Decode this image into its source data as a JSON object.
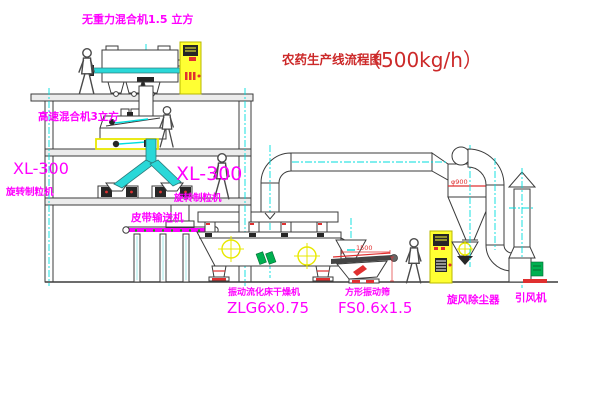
{
  "title": {
    "name": "农药生产线流程图",
    "capacity": "（500kg/h）"
  },
  "equipment": {
    "gravity_mixer": {
      "label": "无重力混合机1.5 立方"
    },
    "high_speed_mixer": {
      "label": "高速混合机3立方"
    },
    "granulator_left": {
      "model": "XL-300",
      "label": "旋转制粒机"
    },
    "granulator_center": {
      "model": "XL-300",
      "label": "旋转制粒机"
    },
    "belt_conveyor": {
      "label": "皮带输送机"
    },
    "dryer": {
      "label": "振动流化床干燥机",
      "model": "ZLG6x0.75"
    },
    "screen": {
      "label": "方形振动筛",
      "model": "FS0.6x1.5"
    },
    "cyclone": {
      "label": "旋风除尘器",
      "dimension": "φ900"
    },
    "fan": {
      "label": "引风机"
    }
  },
  "dimensions": {
    "screen_length": "1500"
  },
  "colors": {
    "label_magenta": "#ff00ff",
    "title_red": "#cc2929",
    "centerline_cyan": "#00dede",
    "cabinet_yellow": "#ffff33",
    "accent_red": "#e03030",
    "accent_green": "#00b050",
    "line": "#3b3b3b"
  }
}
